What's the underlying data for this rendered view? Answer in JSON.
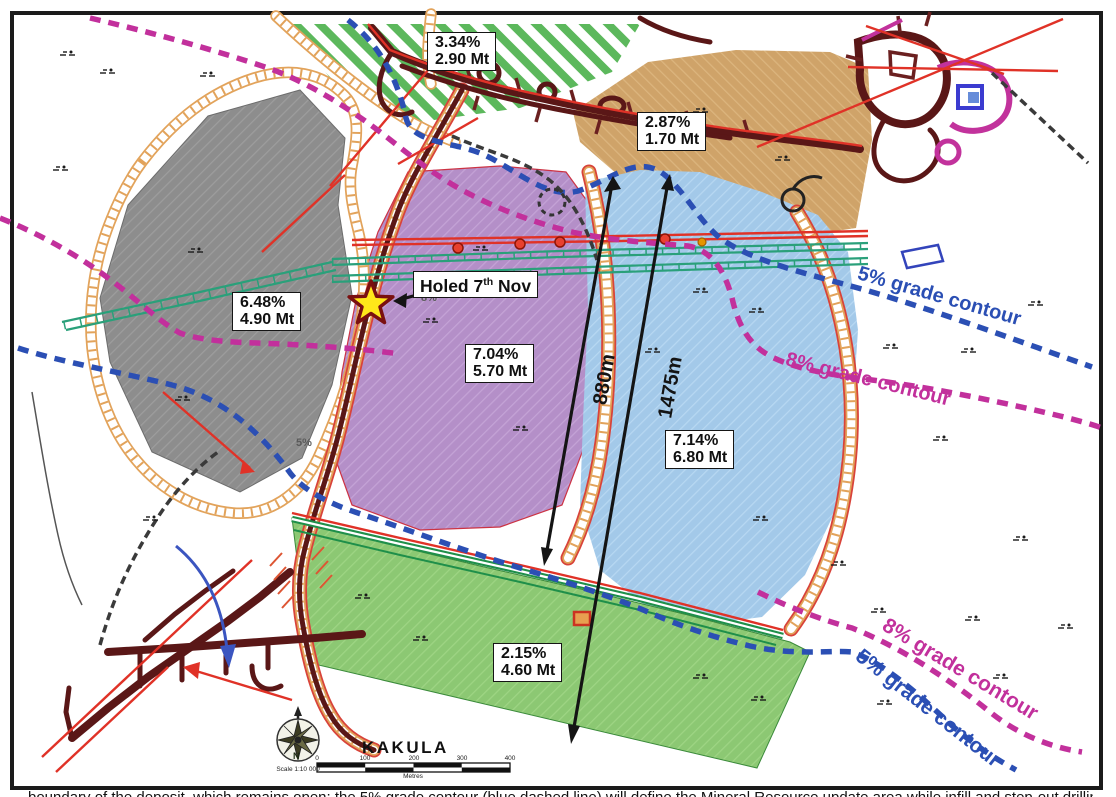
{
  "zones": [
    {
      "id": "north-hatched",
      "grade": "3.34%",
      "tonnage": "2.90 Mt",
      "color": "#5cb85c"
    },
    {
      "id": "northeast-tan",
      "grade": "2.87%",
      "tonnage": "1.70 Mt",
      "color": "#cfa369"
    },
    {
      "id": "west-gray",
      "grade": "6.48%",
      "tonnage": "4.90 Mt",
      "color": "#8d8d8d"
    },
    {
      "id": "central-purple",
      "grade": "7.04%",
      "tonnage": "5.70 Mt",
      "color": "#b48fc8"
    },
    {
      "id": "east-blue",
      "grade": "7.14%",
      "tonnage": "6.80 Mt",
      "color": "#a3c9e9"
    },
    {
      "id": "south-green",
      "grade": "2.15%",
      "tonnage": "4.60 Mt",
      "color": "#8cc873"
    }
  ],
  "holed": {
    "prefix": "Holed 7",
    "sup": "th",
    "suffix": " Nov"
  },
  "distances": [
    {
      "label": "880m"
    },
    {
      "label": "1475m"
    }
  ],
  "contour_labels": {
    "five_right": "5% grade contour",
    "eight_right": "8% grade contour",
    "eight_bottom": "8% grade contour",
    "five_bottom": "5% grade contour"
  },
  "spot_grades": [
    {
      "label": "8%"
    },
    {
      "label": "5%"
    }
  ],
  "footer": {
    "map_title": "KAKULA",
    "north": "N",
    "scale_text": "Scale 1:10 000",
    "scale_ticks": [
      "0",
      "100",
      "200",
      "300",
      "400"
    ],
    "scale_unit": "Metres"
  },
  "caption": "boundary of the deposit, which remains open; the 5% grade contour (blue dashed line) will define the Mineral Resource update area while infill and step-out drilling continues on the extensions",
  "colors": {
    "five_contour": "#2b4fb4",
    "eight_contour": "#c2309c",
    "star_fill": "#ffe81a",
    "star_stroke": "#7a1010",
    "tunnel": "#5a1717",
    "road": "#e2a35b",
    "red_line": "#e03227",
    "teal_line": "#2aa07a",
    "green_line": "#1f8f4a"
  }
}
